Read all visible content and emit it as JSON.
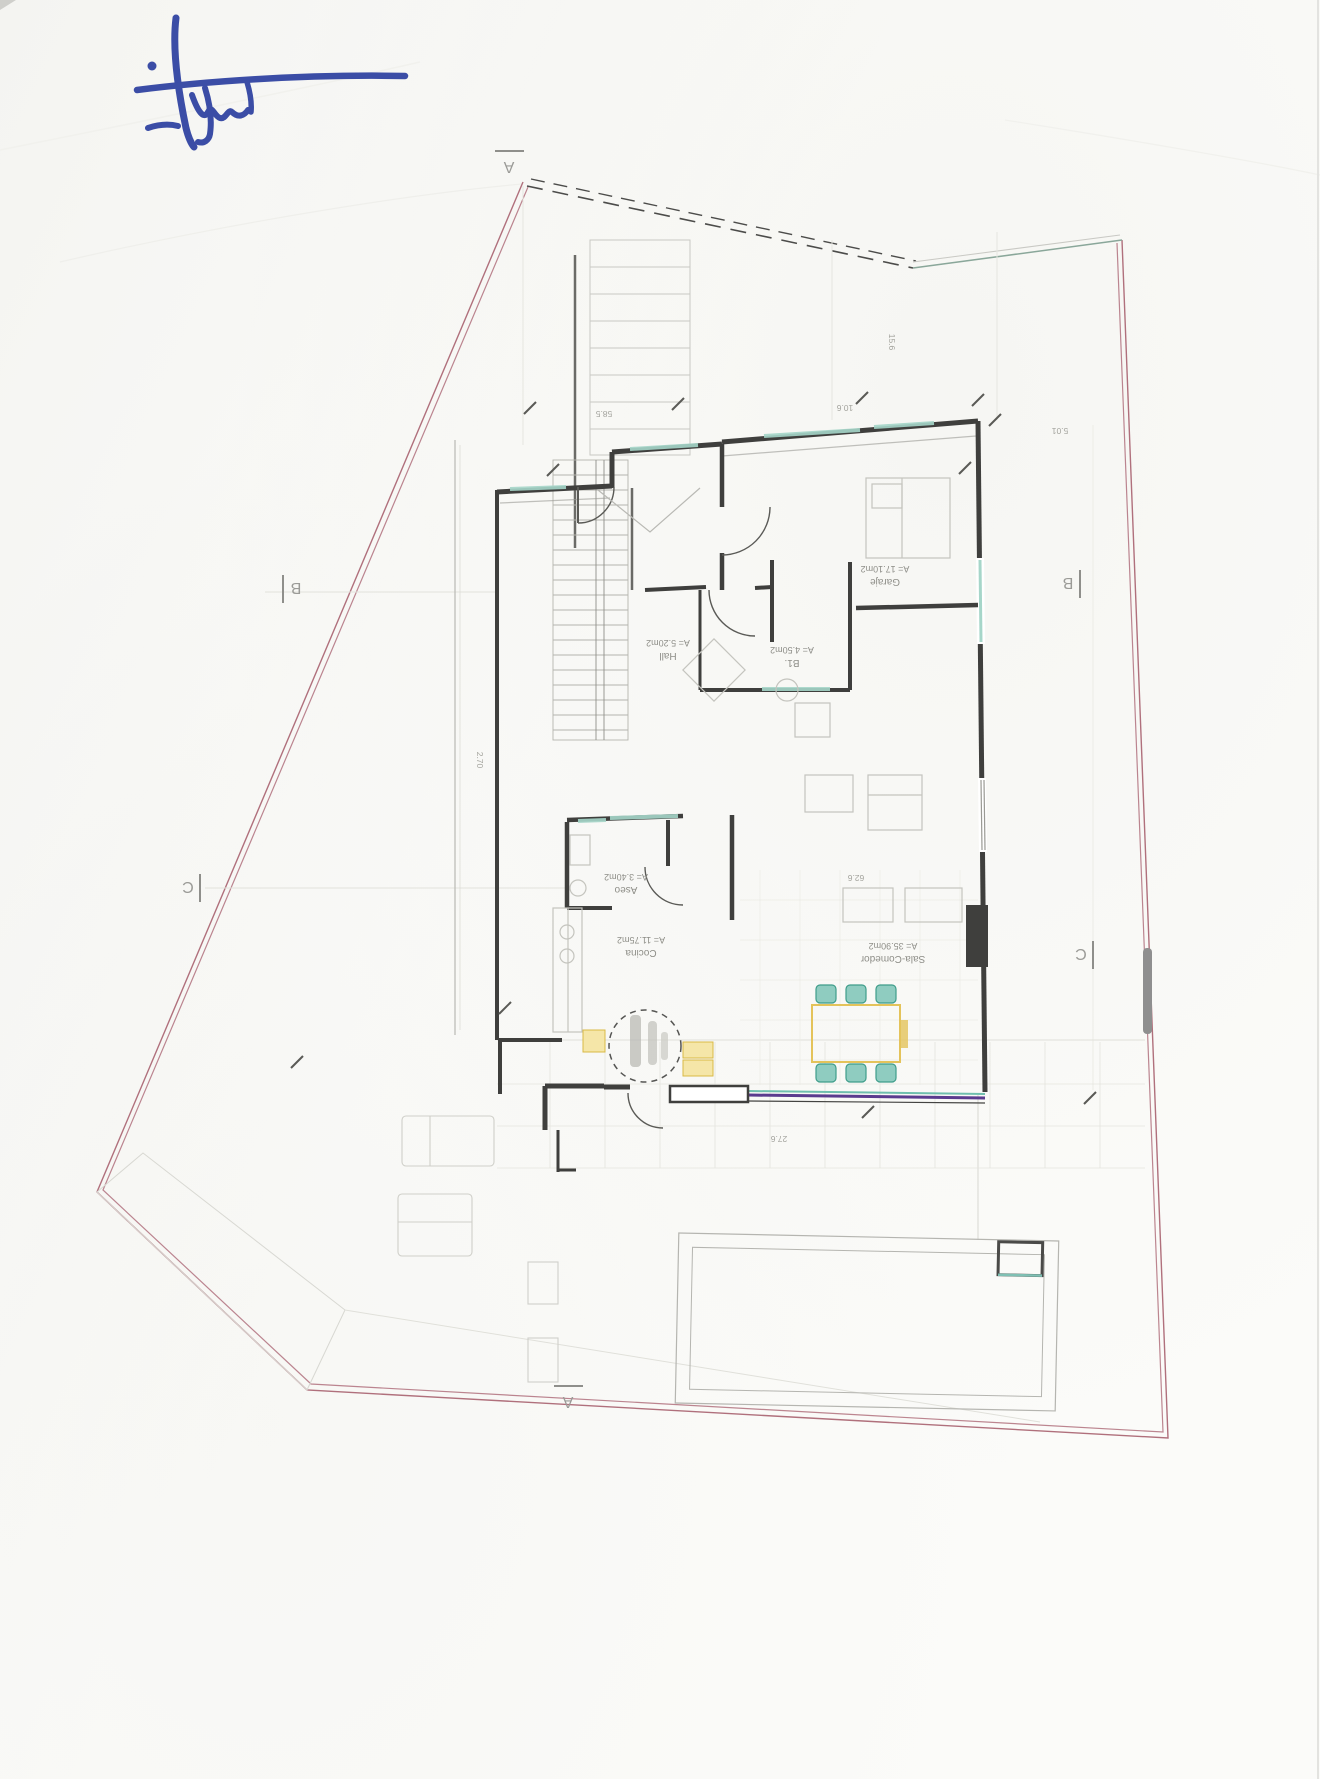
{
  "document": {
    "kind": "scanned architectural floor plan, rotated 180 degrees",
    "paper_color": "#fbfbf9"
  },
  "signature": {
    "ink_color": "#3b4da6"
  },
  "rooms": [
    {
      "label": "Garaje",
      "area": "A= 17.10m2"
    },
    {
      "label": "Hall",
      "area": "A= 5.20m2"
    },
    {
      "label": "B1.",
      "area": "A= 4.50m2"
    },
    {
      "label": "Aseo",
      "area": "A= 3.40m2"
    },
    {
      "label": "Cocina",
      "area": "A= 11.75m2"
    },
    {
      "label": "Sala-Comedor",
      "area": "A= 35.90m2"
    }
  ],
  "markers": [
    {
      "letter": "A",
      "position": "top"
    },
    {
      "letter": "B",
      "position": "left"
    },
    {
      "letter": "B",
      "position": "right"
    },
    {
      "letter": "C",
      "position": "left"
    },
    {
      "letter": "C",
      "position": "right"
    },
    {
      "letter": "A",
      "position": "bottom"
    }
  ],
  "dimensions": [
    {
      "value": "27.6"
    },
    {
      "value": "62.6"
    },
    {
      "value": "58.5"
    },
    {
      "value": "10.6"
    },
    {
      "value": "5.01"
    },
    {
      "value": "15.6"
    },
    {
      "value": "2.70"
    }
  ],
  "colors": {
    "boundary_pink": "#b0707c",
    "wall_dark": "#3f3f3d",
    "window_teal": "#a6d6c9",
    "glazing_purple": "#5a3b8e",
    "furniture_yellow": "#e4c35a",
    "chair_teal": "#6fbfae",
    "scrollbar_gray": "#8f8f8f"
  }
}
